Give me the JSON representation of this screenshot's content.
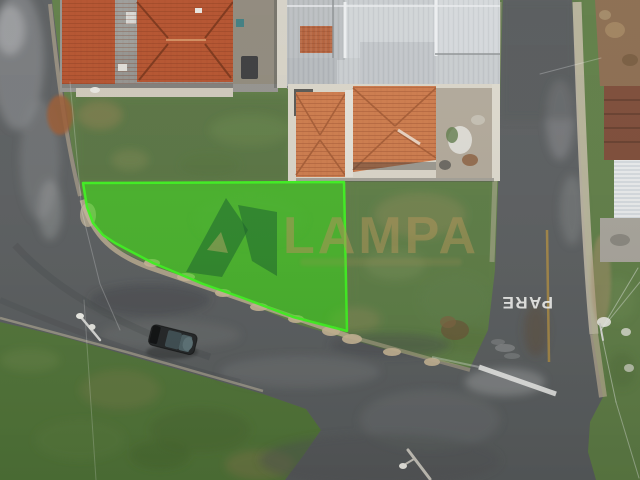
{
  "image": {
    "type": "aerial-drone-photo",
    "subject": "corner land lot highlighted in green at a street intersection",
    "watermark": {
      "brand": "LAMPA"
    },
    "road_marking": {
      "stop_text": "PARE"
    },
    "colors": {
      "highlight_fill": "#2fe60d",
      "highlight_stroke": "#3df51d",
      "grass_base": "#5f7d46",
      "grass_field": "#527539",
      "asphalt": "#5a5d5f",
      "roof_clay_dark": "#b4512c",
      "roof_clay_light": "#cd7a4a",
      "roof_metal": "#c6cacd",
      "concrete": "#cfc8ba",
      "sand": "#c2b193",
      "watermark_gold": "#b09355",
      "stop_text": "#f2f2f0",
      "center_line": "#a98844"
    }
  }
}
